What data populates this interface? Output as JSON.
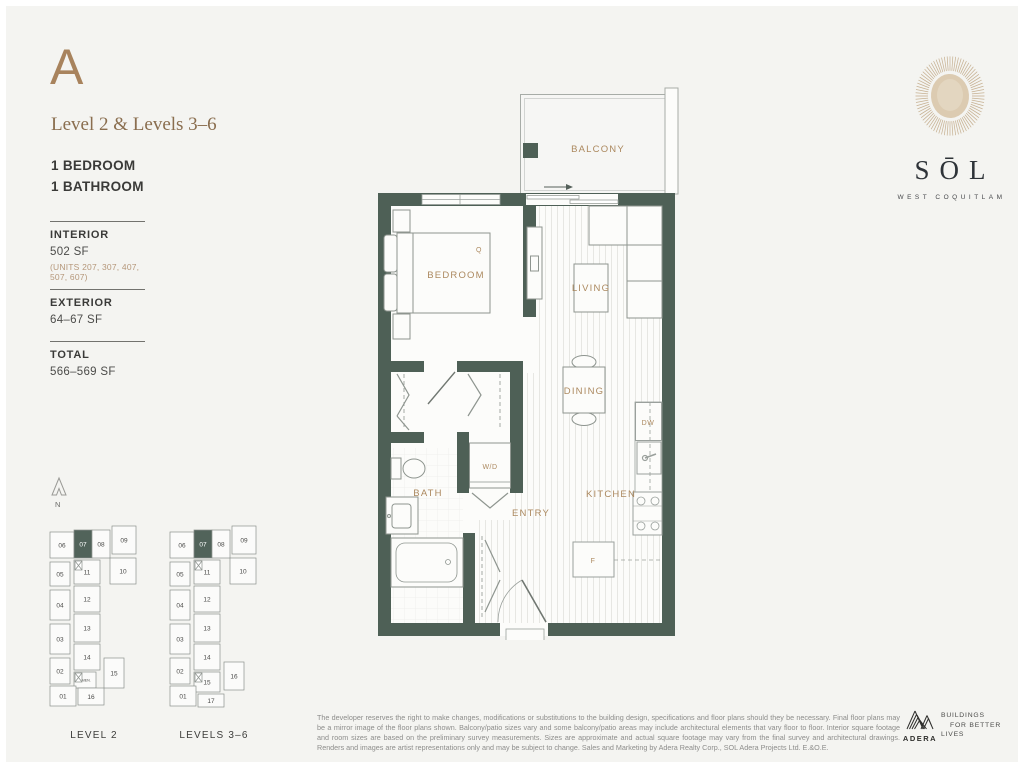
{
  "colors": {
    "background": "#f4f4f1",
    "wall_green": "#4e6056",
    "accent_brown": "#a8835d",
    "label_brown": "#ac895f",
    "text_dark": "#3a3a38",
    "line_gray": "#9aa09c",
    "keyplan_highlight": "#51635a"
  },
  "header": {
    "plan_letter": "A",
    "subtitle": "Level 2 & Levels 3–6",
    "bedrooms": "1 BEDROOM",
    "bathrooms": "1 BATHROOM"
  },
  "stats": [
    {
      "label": "INTERIOR",
      "value": "502 SF",
      "note": "(UNITS 207, 307, 407, 507, 607)"
    },
    {
      "label": "EXTERIOR",
      "value": "64–67 SF",
      "note": ""
    },
    {
      "label": "TOTAL",
      "value": "566–569 SF",
      "note": ""
    }
  ],
  "brand": {
    "wordmark": "SŌL",
    "location": "WEST COQUITLAM"
  },
  "floorplan": {
    "labels": {
      "balcony": "BALCONY",
      "bedroom": "BEDROOM",
      "living": "LIVING",
      "dining": "DINING",
      "kitchen": "KITCHEN",
      "bath": "BATH",
      "entry": "ENTRY",
      "wd": "W/D",
      "queen": "Q",
      "dishwasher": "DW",
      "fridge": "F"
    }
  },
  "keyplans": {
    "north_label": "N",
    "plans": [
      {
        "caption": "LEVEL 2",
        "units": [
          {
            "n": "06",
            "x": 2,
            "y": 12,
            "w": 24,
            "h": 26
          },
          {
            "n": "07",
            "x": 26,
            "y": 10,
            "w": 18,
            "h": 28,
            "hl": true
          },
          {
            "n": "08",
            "x": 44,
            "y": 10,
            "w": 18,
            "h": 28
          },
          {
            "n": "09",
            "x": 64,
            "y": 6,
            "w": 24,
            "h": 28
          },
          {
            "n": "05",
            "x": 2,
            "y": 42,
            "w": 20,
            "h": 24
          },
          {
            "n": "11",
            "x": 26,
            "y": 40,
            "w": 26,
            "h": 24
          },
          {
            "n": "10",
            "x": 62,
            "y": 38,
            "w": 26,
            "h": 26
          },
          {
            "n": "04",
            "x": 2,
            "y": 70,
            "w": 20,
            "h": 30
          },
          {
            "n": "12",
            "x": 26,
            "y": 66,
            "w": 26,
            "h": 26
          },
          {
            "n": "03",
            "x": 2,
            "y": 104,
            "w": 20,
            "h": 30
          },
          {
            "n": "13",
            "x": 26,
            "y": 94,
            "w": 26,
            "h": 28
          },
          {
            "n": "02",
            "x": 2,
            "y": 138,
            "w": 20,
            "h": 26
          },
          {
            "n": "14",
            "x": 26,
            "y": 124,
            "w": 26,
            "h": 26
          },
          {
            "n": "AMEN.",
            "x": 26,
            "y": 152,
            "w": 22,
            "h": 16,
            "small": true
          },
          {
            "n": "15",
            "x": 56,
            "y": 138,
            "w": 20,
            "h": 30
          },
          {
            "n": "01",
            "x": 2,
            "y": 166,
            "w": 26,
            "h": 20
          },
          {
            "n": "16",
            "x": 30,
            "y": 168,
            "w": 26,
            "h": 17
          }
        ],
        "stairs": [
          {
            "x": 27,
            "y": 41
          },
          {
            "x": 27,
            "y": 153
          }
        ]
      },
      {
        "caption": "LEVELS 3–6",
        "units": [
          {
            "n": "06",
            "x": 2,
            "y": 12,
            "w": 24,
            "h": 26
          },
          {
            "n": "07",
            "x": 26,
            "y": 10,
            "w": 18,
            "h": 28,
            "hl": true
          },
          {
            "n": "08",
            "x": 44,
            "y": 10,
            "w": 18,
            "h": 28
          },
          {
            "n": "09",
            "x": 64,
            "y": 6,
            "w": 24,
            "h": 28
          },
          {
            "n": "05",
            "x": 2,
            "y": 42,
            "w": 20,
            "h": 24
          },
          {
            "n": "11",
            "x": 26,
            "y": 40,
            "w": 26,
            "h": 24
          },
          {
            "n": "10",
            "x": 62,
            "y": 38,
            "w": 26,
            "h": 26
          },
          {
            "n": "04",
            "x": 2,
            "y": 70,
            "w": 20,
            "h": 30
          },
          {
            "n": "12",
            "x": 26,
            "y": 66,
            "w": 26,
            "h": 26
          },
          {
            "n": "03",
            "x": 2,
            "y": 104,
            "w": 20,
            "h": 30
          },
          {
            "n": "13",
            "x": 26,
            "y": 94,
            "w": 26,
            "h": 28
          },
          {
            "n": "02",
            "x": 2,
            "y": 138,
            "w": 20,
            "h": 26
          },
          {
            "n": "14",
            "x": 26,
            "y": 124,
            "w": 26,
            "h": 26
          },
          {
            "n": "15",
            "x": 26,
            "y": 152,
            "w": 26,
            "h": 20
          },
          {
            "n": "16",
            "x": 56,
            "y": 142,
            "w": 20,
            "h": 28
          },
          {
            "n": "01",
            "x": 2,
            "y": 166,
            "w": 26,
            "h": 20
          },
          {
            "n": "17",
            "x": 30,
            "y": 174,
            "w": 26,
            "h": 13
          }
        ],
        "stairs": [
          {
            "x": 27,
            "y": 41
          },
          {
            "x": 27,
            "y": 153
          }
        ]
      }
    ]
  },
  "footer": {
    "disclaimer": "The developer reserves the right to make changes, modifications or substitutions to the building design, specifications and floor plans should they be necessary. Final floor plans may be a mirror image of the floor plans shown. Balcony/patio sizes vary and some balcony/patio areas may include architectural elements that vary floor to floor. Interior square footage and room sizes are based on the preliminary survey measurements. Sizes are approximate and actual square footage may vary from the final survey and architectural drawings. Renders and images are artist representations only and may be subject to change. Sales and Marketing by Adera Realty Corp., SOL Adera Projects Ltd. E.&O.E.",
    "adera_name": "ADERA",
    "tagline": [
      "BUILDINGS",
      "FOR BETTER",
      "LIVES"
    ]
  }
}
